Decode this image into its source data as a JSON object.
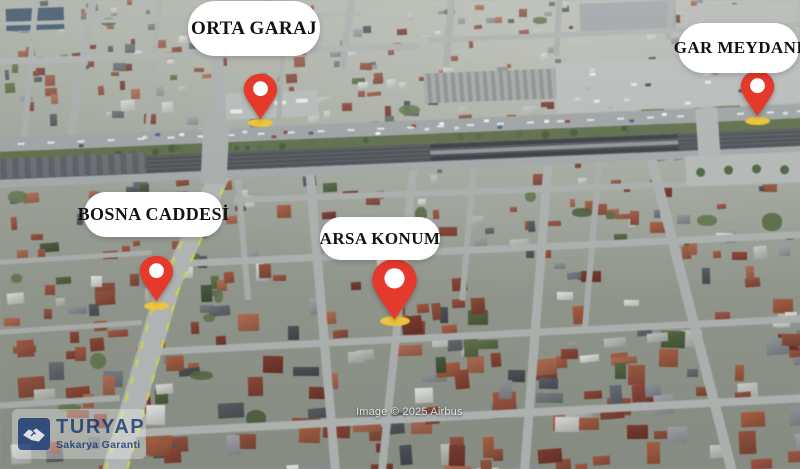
{
  "map": {
    "attribution": "Image © 2025 Airbus",
    "annotations": [
      {
        "name": "orta-garaj",
        "label": "ORTA GARAJ"
      },
      {
        "name": "gar-meydani",
        "label": "GAR MEYDANI"
      },
      {
        "name": "bosna-caddesi",
        "label": "BOSNA CADDESİ"
      },
      {
        "name": "arsa-konum",
        "label": "ARSA KONUM"
      }
    ],
    "colors": {
      "pin": "#E5392B",
      "pin_base": "#ECC43D",
      "label_bg": "#FFFFFF",
      "label_text": "#121212",
      "road": "#A6ABAB",
      "road_marking_yellow": "#D4D838",
      "roof_red": "#9B4A36",
      "rail_dark": "#42474D",
      "green": "#55683F"
    }
  },
  "branding": {
    "name": "TURYAP",
    "tagline": "Sakarya Garanti",
    "color": "#1E3F7A"
  }
}
